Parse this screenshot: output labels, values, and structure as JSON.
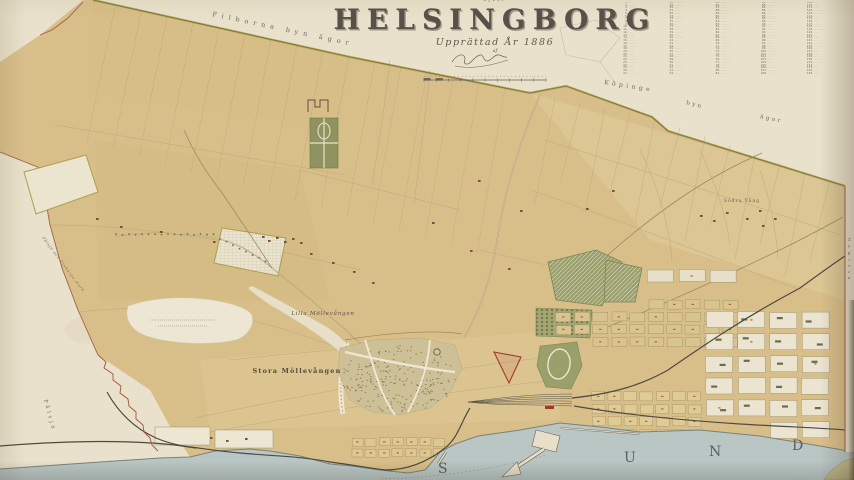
{
  "title_block": {
    "over": "öfver",
    "title": "HELSINGBORG",
    "subtitle": "Upprättad År 1886",
    "af": "af"
  },
  "index": {
    "columns": 5,
    "rows_per_column": 27,
    "placeholder_name": "·········"
  },
  "labels": {
    "filborna": "Filborna byn ägor",
    "kopinge": "Köpinge",
    "kopinge2": "byn",
    "kopinge3": "ägor",
    "lilla": "Lilla Möllevången",
    "stora": "Stora Möllevången",
    "palsjo": "Pålsjö",
    "palsjo_road": "Pålsjö och Tinkarps mark",
    "sodra_vang": "Södra Vång",
    "ramlosa": "Ramlösa",
    "sund": [
      "S",
      "U",
      "N",
      "D"
    ]
  },
  "colors": {
    "paper": "#e9e1cb",
    "land": "#d8bf8a",
    "land_light": "#e2d2a6",
    "land_dark": "#cdb176",
    "water": "#b9c6c4",
    "olive_border": "#ac9e4d",
    "park_green": "#989c66",
    "park_dark": "#6f7548",
    "white_area": "#ece6d3",
    "red_mark": "#b04a32",
    "rail": "#4e4a42",
    "ink": "#57514a"
  }
}
